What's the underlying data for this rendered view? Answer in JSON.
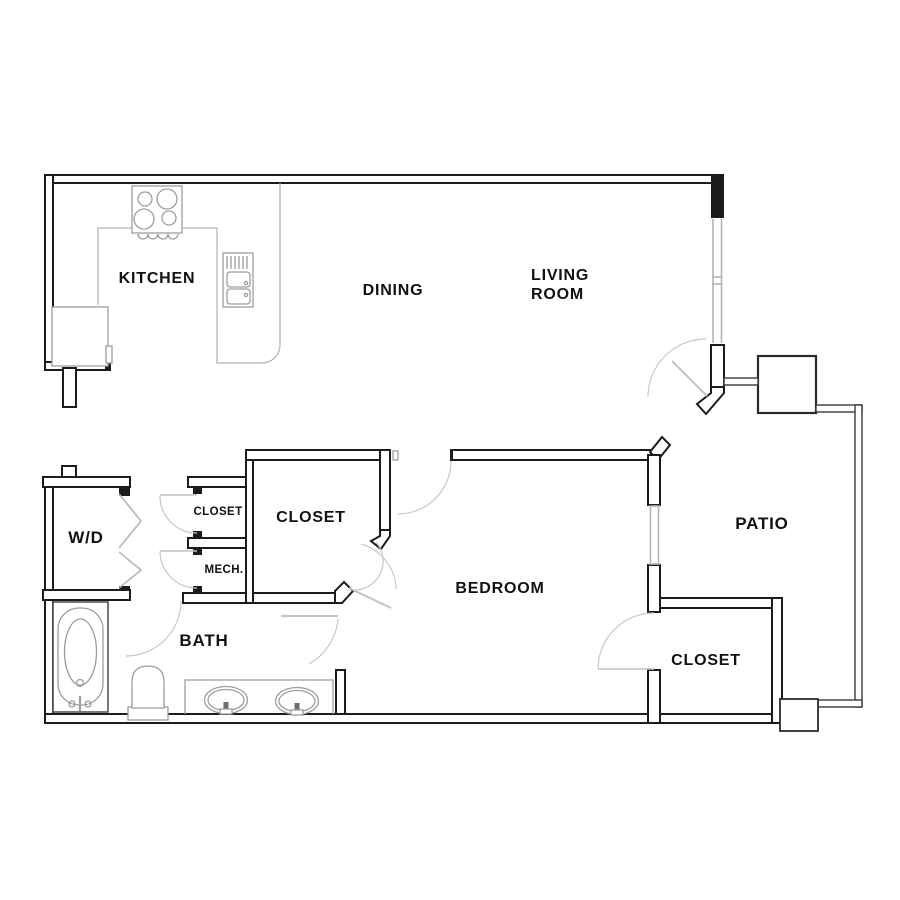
{
  "plan": {
    "type": "apartment-floor-plan",
    "rooms": {
      "kitchen": "KITCHEN",
      "dining": "DINING",
      "living_line1": "LIVING",
      "living_line2": "ROOM",
      "washer_dryer": "W/D",
      "closet_small": "CLOSET",
      "mech": "MECH.",
      "closet_walkin": "CLOSET",
      "bath": "BATH",
      "bedroom": "BEDROOM",
      "closet_bedroom": "CLOSET",
      "patio": "PATIO"
    },
    "colors": {
      "wall": "#1c1c1c",
      "fixture": "#9d9d9d",
      "counter": "#b0b0b0",
      "door_arc": "#c9c9c9",
      "window": "#b4b4b4",
      "railing": "#3a3a3a",
      "label": "#111111",
      "background": "#ffffff"
    },
    "fixtures": [
      "stove-4-burner",
      "kitchen-double-sink",
      "refrigerator",
      "washer-dryer-bifold-doors",
      "bathtub",
      "toilet",
      "double-sink-vanity",
      "patio-storage-box"
    ]
  }
}
